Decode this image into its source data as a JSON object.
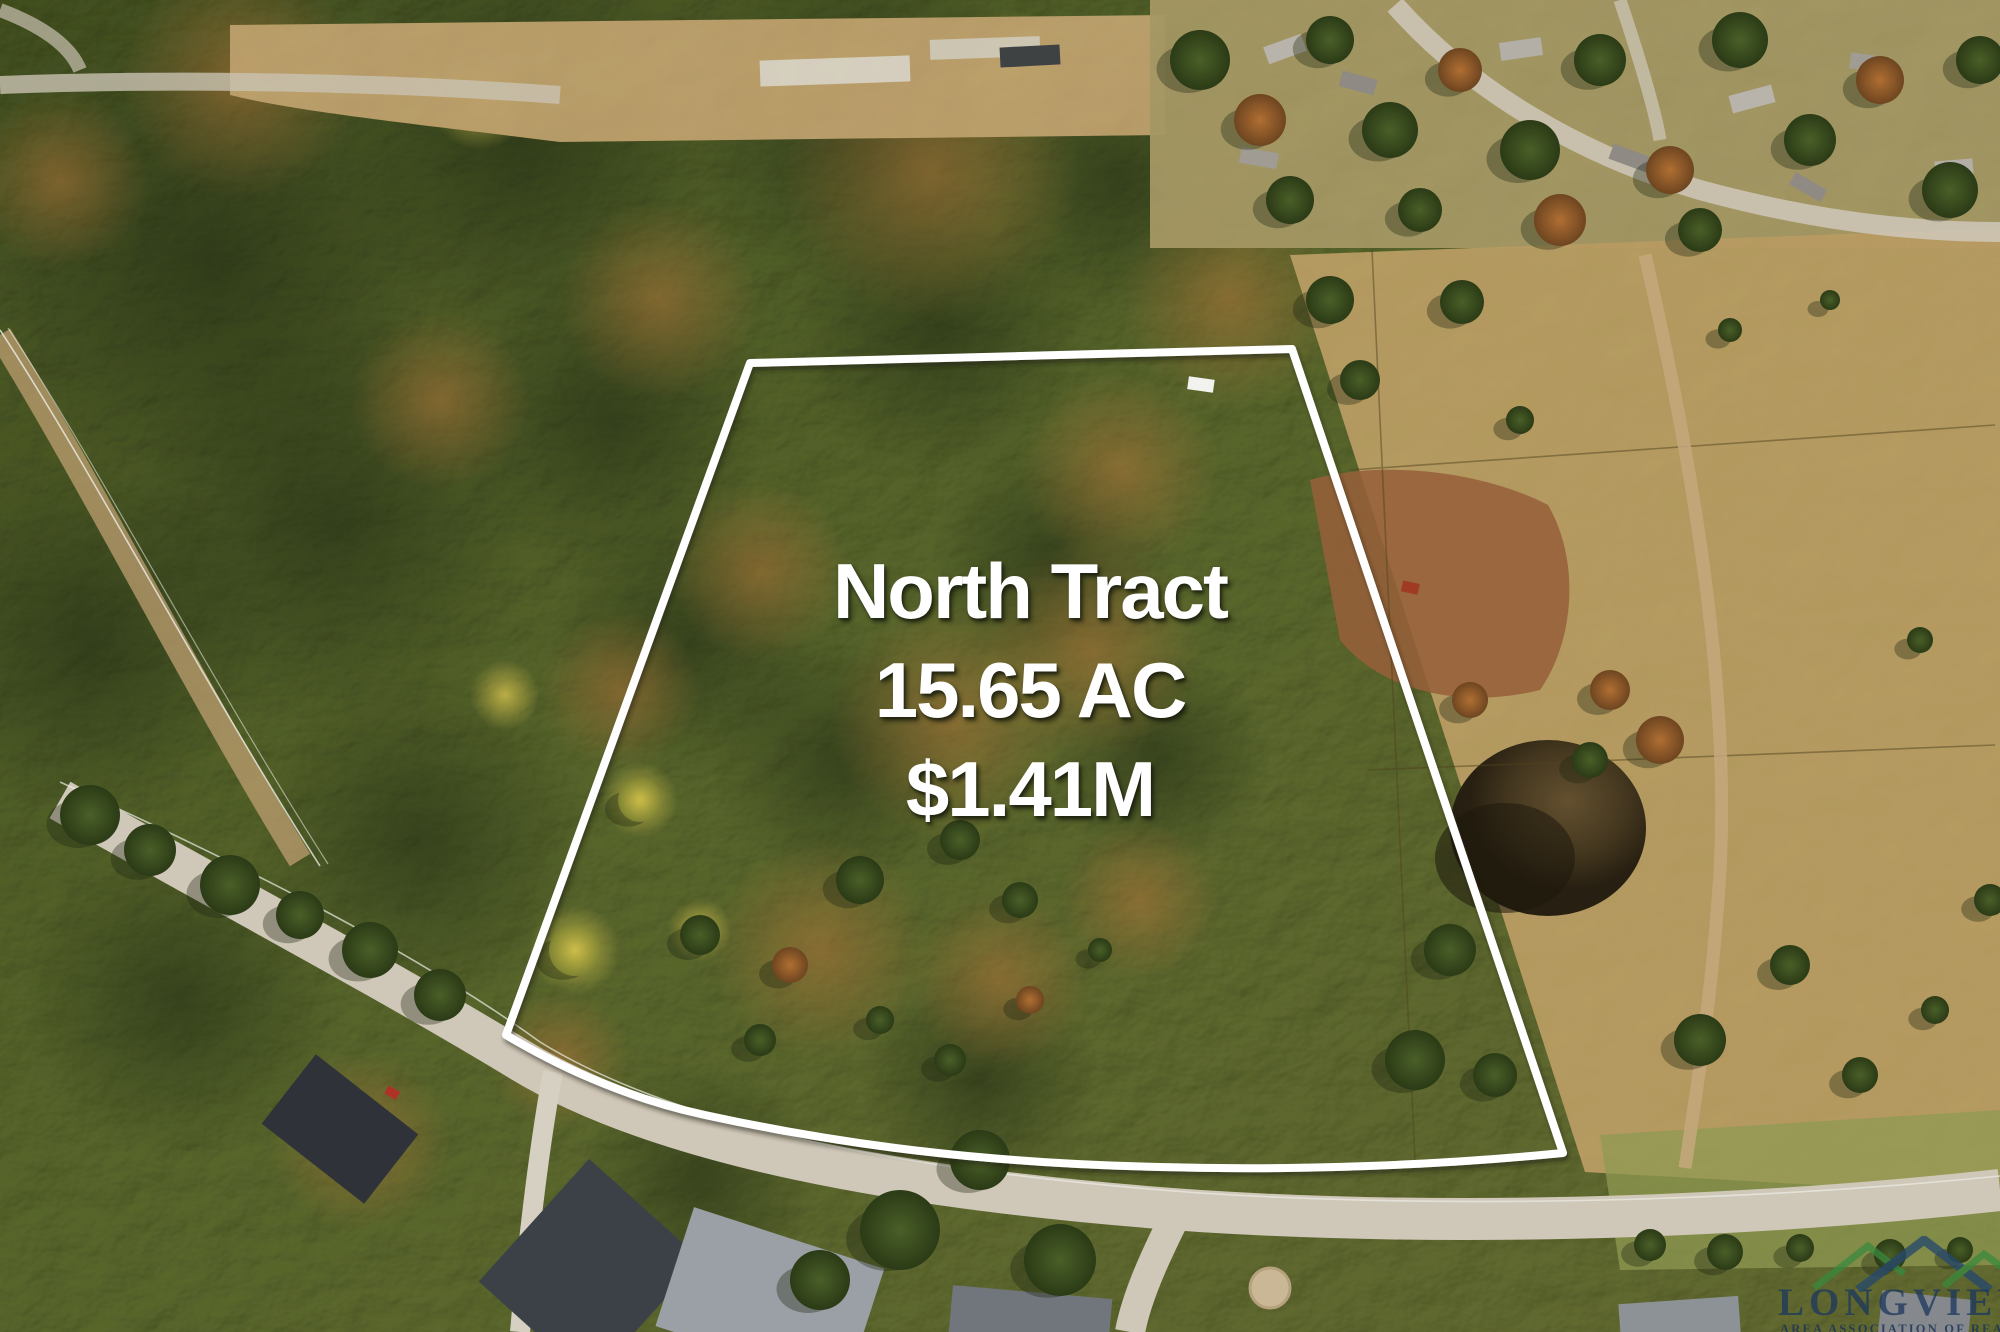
{
  "image_type": "aerial-drone-photo-of-land-listing",
  "overlay": {
    "title": "North Tract",
    "acreage": "15.65 AC",
    "price": "$1.41M",
    "text_color": "#ffffff"
  },
  "parcel": {
    "label": "North Tract",
    "boundary_color": "#ffffff",
    "boundary_path": "M 750 363 L 1292 349 L 1563 1153 C 1440 1165 1300 1171 1160 1167 C 980 1163 838 1144 705 1115 C 618 1096 552 1062 506 1035 Z"
  },
  "watermark": {
    "org_name": "LONGVIEW",
    "org_subtitle": "AREA ASSOCIATION OF REALTORS",
    "text_color": "#1b375e",
    "logo_green": "#3a8a3e",
    "logo_blue": "#27496d"
  }
}
